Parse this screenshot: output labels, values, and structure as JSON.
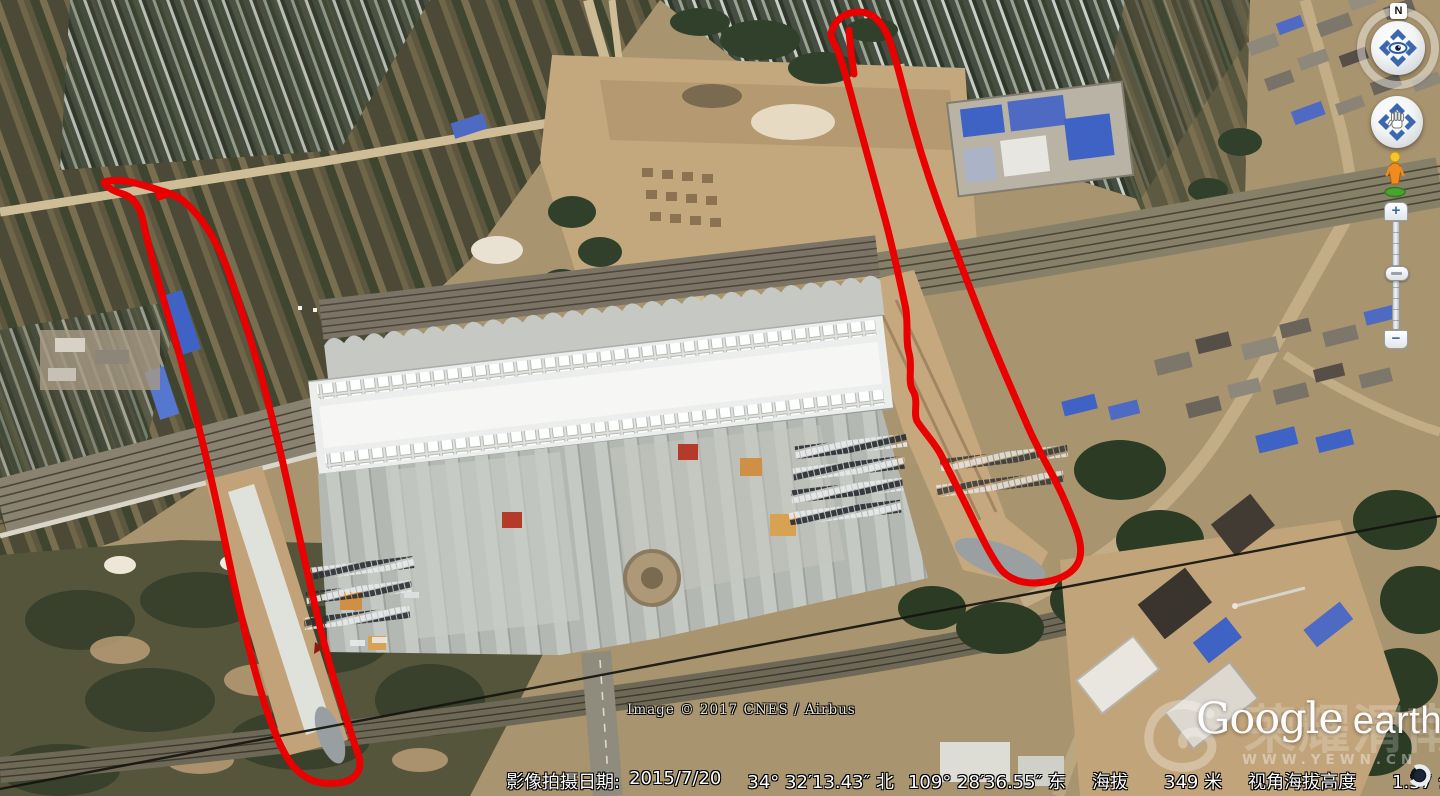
{
  "status_bar": {
    "imagery_date_label": "影像拍摄日期:",
    "imagery_date_value": "2015/7/20",
    "latitude": "34° 32′13.43″ 北",
    "longitude": "109° 28′36.55″ 东",
    "elevation_label": "海拔",
    "elevation_value": "349 米",
    "eye_altitude_label": "视角海拔高度",
    "eye_altitude_value": "1.37 公里"
  },
  "overlays": {
    "attribution": "Image © 2017 CNES / Airbus",
    "logo_google": "Google",
    "logo_earth": "earth",
    "watermark_text": "荣耀渭南",
    "watermark_url": "WWW.YEWN.CN"
  },
  "navigation": {
    "north_indicator": "N",
    "zoom_in_label": "+",
    "zoom_out_label": "−"
  },
  "annotations": {
    "color": "#e90000",
    "left_loop_path": "M104 182 C120 177 140 184 162 191 C172 194 180 197 188 205 C207 223 221 249 232 282 C243 315 253 346 263 383 C276 431 286 476 297 526 C307 571 319 626 331 669 C341 704 353 739 359 757 C363 772 353 782 337 783 C319 785 305 780 293 766 C279 748 269 719 259 685 C247 643 237 599 229 561 C219 513 209 466 197 421 C185 374 173 331 161 291 C153 263 147 239 143 221 C140 206 133 197 123 194 C113 191 106 187 104 182 Z",
    "left_loop_arrow_path": "M152 184 L180 194 L157 201 Z",
    "right_loop_path": "M831 34 C834 20 845 12 859 12 C873 12 883 23 889 39 C897 61 904 93 913 125 C923 161 935 197 949 233 C961 265 973 297 987 331 C1000 363 1015 397 1029 429 C1041 456 1057 481 1067 506 C1075 525 1083 543 1080 557 C1077 571 1063 579 1045 582 C1027 585 1009 581 999 567 C987 550 977 527 965 503 C955 483 947 467 941 455 C935 443 923 431 917 421 C913 413 919 401 913 391 C907 381 913 367 909 353 C905 339 909 321 905 305 C899 277 893 249 885 219 C877 189 867 153 857 117 C850 91 843 63 837 49 C833 41 831 38 831 34 Z",
    "right_loop_tick_path": "M849 30 C850 45 852 60 854 74"
  }
}
